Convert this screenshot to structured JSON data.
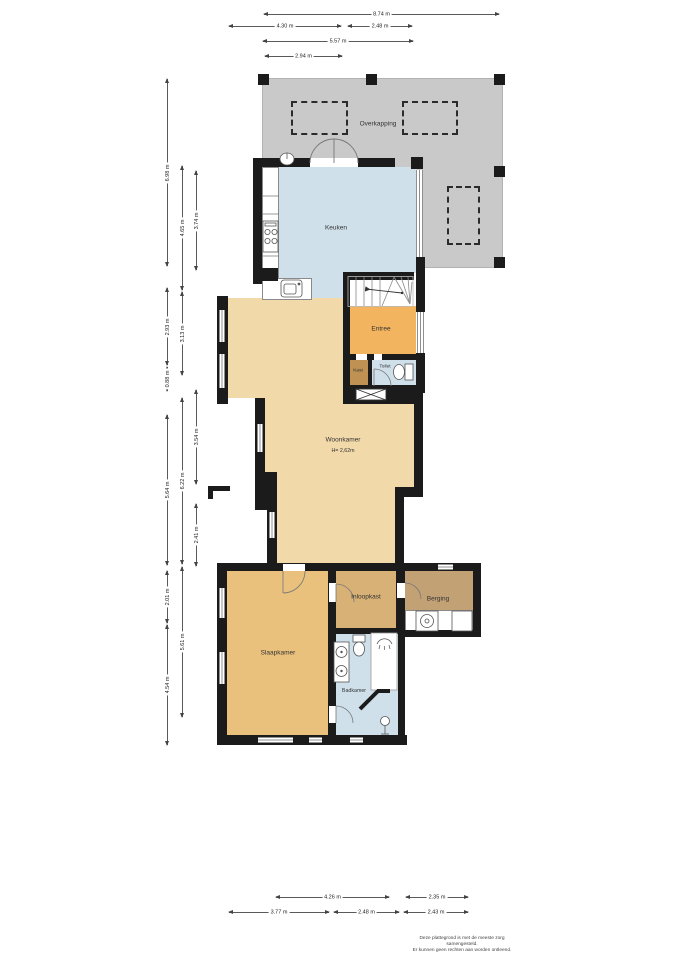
{
  "rooms": {
    "overkapping": "Overkapping",
    "keuken": "Keuken",
    "entree": "Entree",
    "kast": "Kast",
    "toilet": "Toilet",
    "woonkamer": "Woonkamer",
    "woonkamer_ceiling": "H= 2,62m",
    "slaapkamer": "Slaapkamer",
    "inloopkast": "Inloopkast",
    "berging": "Berging",
    "badkamer": "Badkamer"
  },
  "dims": {
    "top": [
      "8.74 m",
      "4.30 m",
      "2.48 m",
      "5.57 m",
      "2.94 m"
    ],
    "left": [
      "6.98 m",
      "2.93 m",
      "0.88 m",
      "5.64 m",
      "2.01 m",
      "4.54 m",
      "4.65 m",
      "3.13 m",
      "6.22 m",
      "5.61 m",
      "3.74 m",
      "3.54 m",
      "2.41 m"
    ],
    "bottom": [
      "4.26 m",
      "2.35 m",
      "3.77 m",
      "2.48 m",
      "2.43 m"
    ]
  },
  "footer": {
    "line1": "Deze plattegrond is met de meeste zorg samengesteld.",
    "line2": "Er kunnen geen rechten aan worden ontleend."
  },
  "colors": {
    "wall": "#1b1b1b",
    "overkapping": "#c9c9c9",
    "water_room": "#cfe0eb",
    "living": "#f2d9a9",
    "entree": "#f3b45f",
    "kast": "#bf9254",
    "slaapkamer": "#e9c17c",
    "inloopkast": "#d7b175",
    "berging": "#c2a175"
  }
}
